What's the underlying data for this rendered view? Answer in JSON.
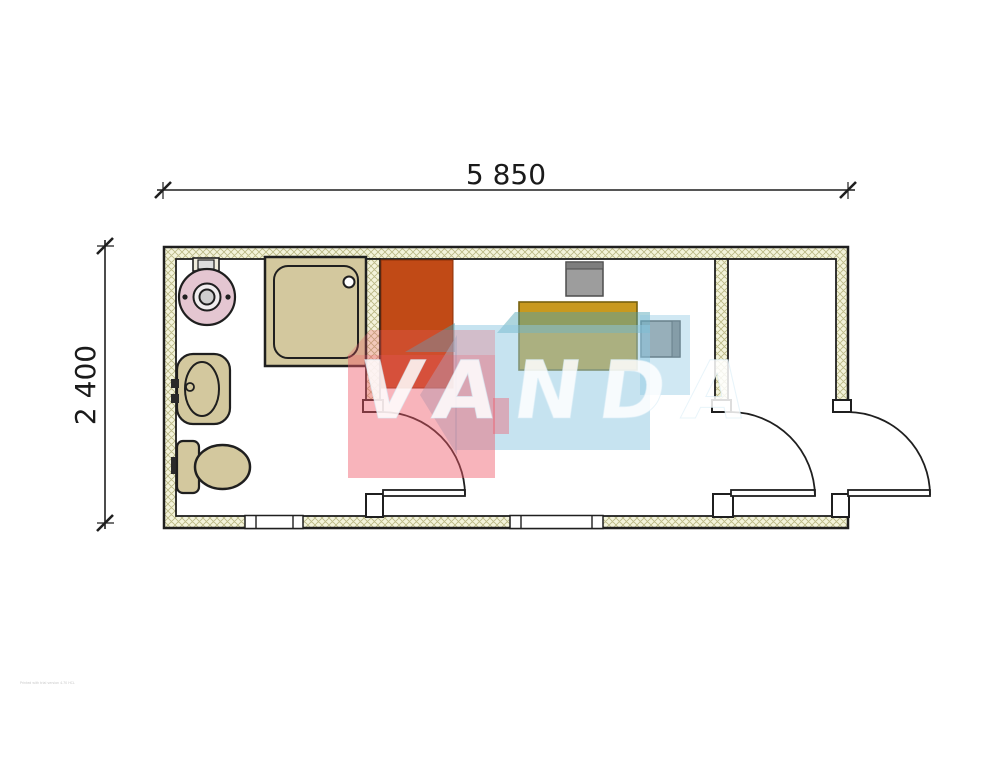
{
  "dimensions": {
    "width_label": "5 850",
    "height_label": "2 400"
  },
  "watermark": {
    "brand": "VANDA"
  },
  "fine_print": "Printed with trial version 4.70 HCL",
  "colors": {
    "outline": "#1f1f1f",
    "wall_fill": "#f3f3da",
    "hatch_line": "#b9b784",
    "floor": "#ffffff",
    "fixture": "#d3c89e",
    "boiler": "#e4c6d1",
    "boiler_ring": "#f0edee",
    "boiler_core": "#cfcfcf",
    "wardrobe": "#c14a16",
    "desk": "#c8991f",
    "desk_outline": "#77620f",
    "chair": "#9d9d9d",
    "chair_dark": "#7e7e7e",
    "watermark_blue": "#8ec8e2",
    "watermark_teal": "#4aa2b4",
    "watermark_red": "#ef5868",
    "watermark_text": "#ffffff",
    "dimension_text": "#1a1a1a"
  }
}
